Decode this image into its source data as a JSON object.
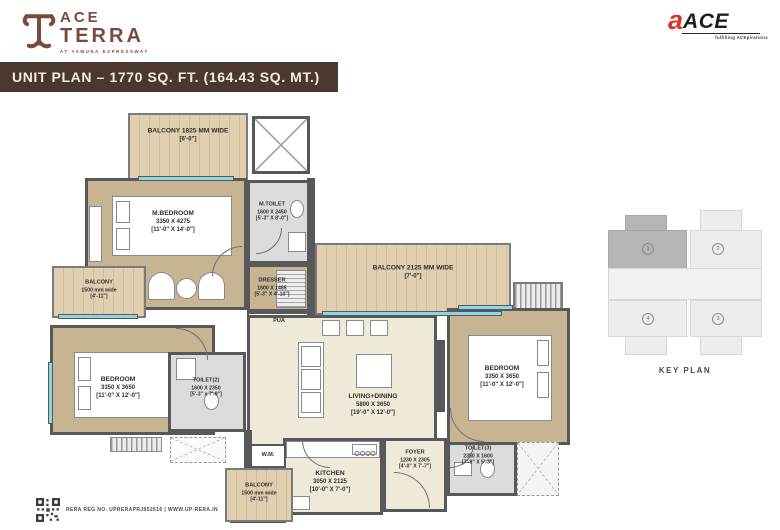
{
  "brand": {
    "line1": "ACE",
    "line2": "TERRA",
    "tagline": "AT YAMUNA EXPRESSWAY"
  },
  "developer": {
    "mark": "a",
    "name": "ACE",
    "tagline": "fulfilling ACEpirations"
  },
  "title_bar": "UNIT PLAN – 1770 SQ. FT. (164.43 SQ. MT.)",
  "rooms": {
    "balcony_top": {
      "name": "BALCONY 1825 MM WIDE",
      "ft": "[6'-0\"]"
    },
    "m_bedroom": {
      "name": "M.BEDROOM",
      "mm": "3350 X 4275",
      "ft": "[11'-0\" X 14'-0\"]"
    },
    "m_toilet": {
      "name": "M.TOILET",
      "mm": "1600 X 2450",
      "ft": "[5'-3\" X 8'-0\"]"
    },
    "dresser": {
      "name": "DRESSER",
      "mm": "1600 X 1485",
      "ft": "[5'-3\" X 4'-10\"]"
    },
    "pua": {
      "name": "PUA"
    },
    "balcony_left": {
      "name": "BALCONY",
      "mm": "1500 mm wide",
      "ft": "[4'-11\"]"
    },
    "balcony_center": {
      "name": "BALCONY 2125 MM WIDE",
      "ft": "[7'-0\"]"
    },
    "bedroom_left": {
      "name": "BEDROOM",
      "mm": "3350 X 3650",
      "ft": "[11'-0\" X 12'-0\"]"
    },
    "toilet_2": {
      "name": "TOILET(2)",
      "mm": "1600 X 2350",
      "ft": "[5'-3\" x 7'-9\"]"
    },
    "living_dining": {
      "name": "LIVING+DINING",
      "mm": "5800 X 3650",
      "ft": "[19'-0\" X 12'-0\"]"
    },
    "bedroom_right": {
      "name": "BEDROOM",
      "mm": "3350 X 3650",
      "ft": "[11'-0\" X 12'-0\"]"
    },
    "kitchen": {
      "name": "KITCHEN",
      "mm": "3050 X 2125",
      "ft": "[10'-0\" X 7'-0\"]"
    },
    "foyer": {
      "name": "FOYER",
      "mm": "1230 X 2305",
      "ft": "[4'-0\" X 7'-7\"]"
    },
    "toilet_3": {
      "name": "TOILET(3)",
      "mm": "2350 X 1600",
      "ft": "[7'-9\" X 5'-3\"]"
    },
    "wm": {
      "name": "W.M."
    },
    "balcony_bottom": {
      "name": "BALCONY",
      "mm": "1500 mm wide",
      "ft": "[4'-11\"]"
    }
  },
  "key_plan": {
    "title": "KEY PLAN",
    "units": [
      "1",
      "2",
      "3",
      "4"
    ],
    "highlighted_unit": "1"
  },
  "footer": {
    "rera_text": "RERA REG NO. UPRERAPRJ952616 | WWW.UP-RERA.IN"
  },
  "colors": {
    "brand_brown": "#7a4b3b",
    "title_bar": "#4a382f",
    "floor_tan": "#c7b492",
    "balcony_wood": "#ddcbad",
    "toilet_gray": "#dcdcda",
    "living_cream": "#efe9d9",
    "window_cyan": "#8fd6e2",
    "wall": "#57585a",
    "ace_red": "#d9342b",
    "keyplan_highlight": "#b5b5b5",
    "keyplan_light": "#ededed"
  }
}
